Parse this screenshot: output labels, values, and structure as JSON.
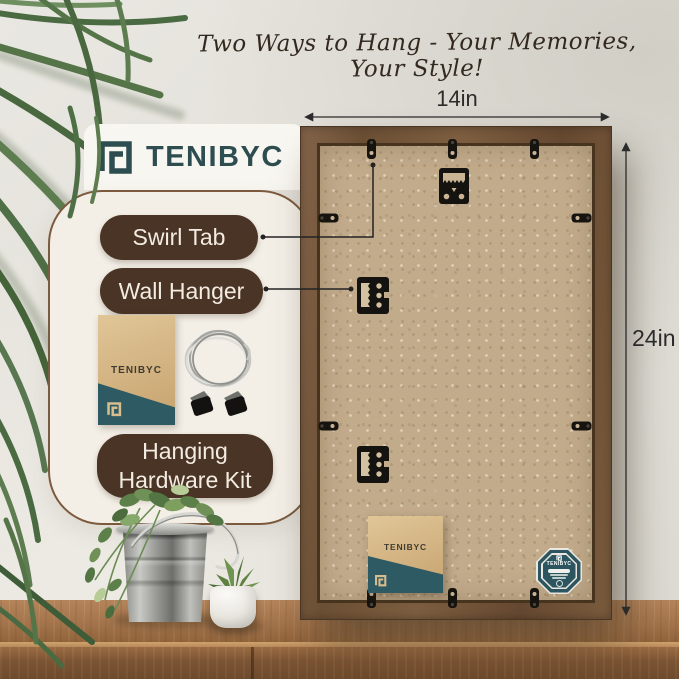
{
  "headline": "Two Ways to Hang - Your Memories, Your Style!",
  "brand": {
    "name": "TENIBYC"
  },
  "callouts": {
    "swirl_tab": "Swirl Tab",
    "wall_hanger": "Wall Hanger",
    "hardware_kit": "Hanging Hardware Kit"
  },
  "dimensions": {
    "width": "14in",
    "height": "24in"
  },
  "icons": {
    "brand_logo": "square-spiral-frame-logo",
    "sawtooth_hanger": "sawtooth-hanger-icon",
    "wall_hanger_bracket": "wall-hanger-bracket-icon",
    "swirl_tab": "swirl-tab-icon",
    "wire_coil": "hanging-wire-coil-icon",
    "clips": "hanging-clip-icon",
    "badge": "brand-seal-badge-icon"
  },
  "colors": {
    "wall": "#e4e2db",
    "panel": "#f3efe7",
    "panel_border": "#7d5a3e",
    "pill": "#4a3425",
    "pill_text": "#f3ece2",
    "frame_wood": "#75573a",
    "kraft_back": "#c2ab8b",
    "brand_teal": "#2e5a64",
    "logo_teal": "#2e4d50",
    "annotation": "#2b2b2b"
  }
}
